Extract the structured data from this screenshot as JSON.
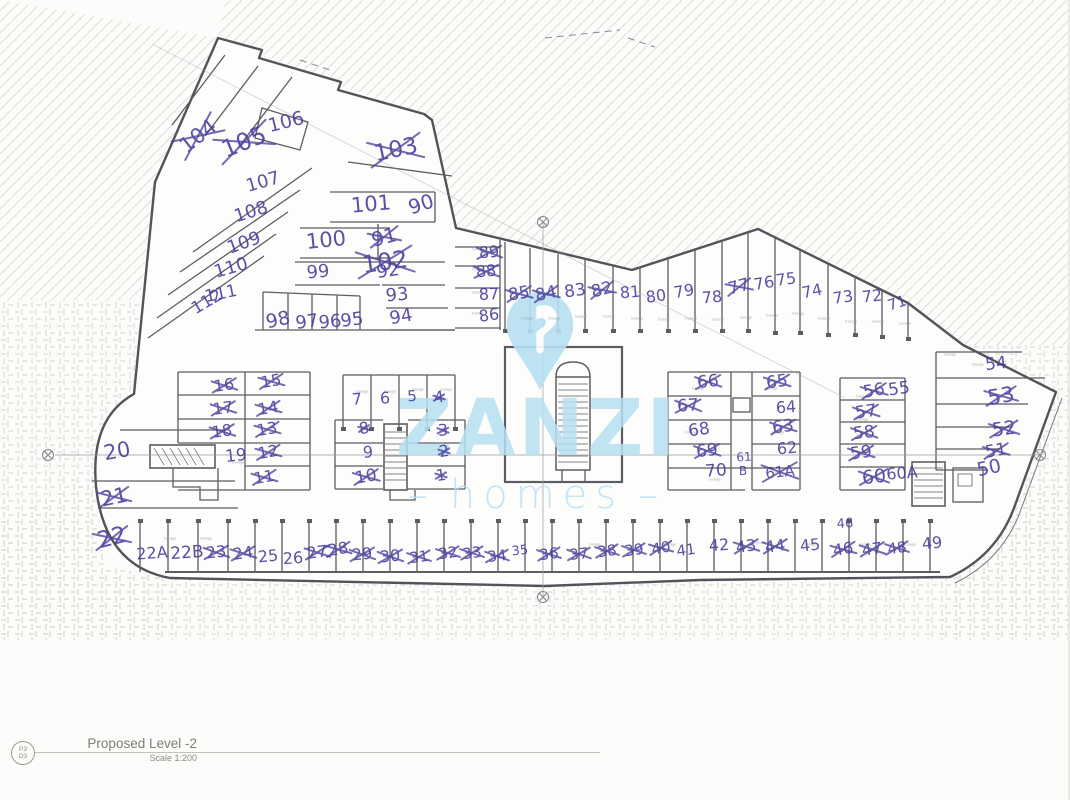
{
  "colors": {
    "ink": "#4a3f9d",
    "watermark": "#b7e0f2",
    "walls": "#55555a"
  },
  "title_block": {
    "sheet_top": "P3",
    "sheet_bottom": "D3",
    "title": "Proposed Level -2",
    "scale": "Scale 1:200"
  },
  "watermark": {
    "brand": "ZANZI",
    "word": "homes",
    "dash": "–"
  },
  "garage_label": "Garage",
  "garage_tags": [
    [
      517,
      316
    ],
    [
      544,
      316
    ],
    [
      571,
      314
    ],
    [
      599,
      314
    ],
    [
      627,
      316
    ],
    [
      654,
      317
    ],
    [
      681,
      316
    ],
    [
      708,
      317
    ],
    [
      736,
      315
    ],
    [
      762,
      313
    ],
    [
      788,
      311
    ],
    [
      814,
      316
    ],
    [
      841,
      319
    ],
    [
      868,
      319
    ],
    [
      895,
      321
    ],
    [
      468,
      247
    ],
    [
      468,
      267
    ],
    [
      468,
      290
    ],
    [
      468,
      311
    ],
    [
      352,
      389
    ],
    [
      380,
      389
    ],
    [
      408,
      387
    ],
    [
      436,
      387
    ],
    [
      688,
      386
    ],
    [
      762,
      386
    ],
    [
      681,
      430
    ],
    [
      768,
      430
    ],
    [
      852,
      394
    ],
    [
      852,
      417
    ],
    [
      160,
      536
    ],
    [
      196,
      536
    ],
    [
      585,
      542
    ],
    [
      660,
      542
    ],
    [
      750,
      540
    ],
    [
      800,
      542
    ],
    [
      855,
      542
    ],
    [
      900,
      542
    ],
    [
      940,
      352
    ],
    [
      968,
      362
    ],
    [
      705,
      477
    ],
    [
      228,
      460
    ]
  ],
  "stalls": [
    {
      "label": "104",
      "x": 198,
      "y": 136,
      "size": 21,
      "rot": -38,
      "crossed": true
    },
    {
      "label": "105",
      "x": 244,
      "y": 142,
      "size": 24,
      "rot": -22,
      "crossed": true
    },
    {
      "label": "106",
      "x": 286,
      "y": 122,
      "size": 19,
      "rot": -14,
      "crossed": false
    },
    {
      "label": "103",
      "x": 396,
      "y": 150,
      "size": 23,
      "rot": -12,
      "crossed": true
    },
    {
      "label": "107",
      "x": 263,
      "y": 182,
      "size": 18,
      "rot": -16,
      "crossed": false
    },
    {
      "label": "108",
      "x": 251,
      "y": 212,
      "size": 18,
      "rot": -18,
      "crossed": false
    },
    {
      "label": "109",
      "x": 244,
      "y": 243,
      "size": 18,
      "rot": -20,
      "crossed": false
    },
    {
      "label": "110",
      "x": 231,
      "y": 268,
      "size": 18,
      "rot": -16,
      "crossed": false
    },
    {
      "label": "111",
      "x": 221,
      "y": 294,
      "size": 17,
      "rot": -12,
      "crossed": false
    },
    {
      "label": "112",
      "x": 207,
      "y": 302,
      "size": 17,
      "rot": -30,
      "crossed": false
    },
    {
      "label": "102",
      "x": 385,
      "y": 262,
      "size": 24,
      "rot": -8,
      "crossed": true
    },
    {
      "label": "101",
      "x": 371,
      "y": 204,
      "size": 21,
      "rot": -5,
      "crossed": false
    },
    {
      "label": "90",
      "x": 421,
      "y": 204,
      "size": 20,
      "rot": -18,
      "crossed": false
    },
    {
      "label": "100",
      "x": 326,
      "y": 240,
      "size": 21,
      "rot": -6,
      "crossed": false
    },
    {
      "label": "91",
      "x": 384,
      "y": 237,
      "size": 20,
      "rot": -15,
      "crossed": true
    },
    {
      "label": "99",
      "x": 318,
      "y": 272,
      "size": 18,
      "rot": -5,
      "crossed": false
    },
    {
      "label": "92",
      "x": 388,
      "y": 271,
      "size": 18,
      "rot": -8,
      "crossed": false
    },
    {
      "label": "93",
      "x": 397,
      "y": 295,
      "size": 18,
      "rot": -5,
      "crossed": false
    },
    {
      "label": "94",
      "x": 401,
      "y": 317,
      "size": 18,
      "rot": -10,
      "crossed": false
    },
    {
      "label": "98",
      "x": 278,
      "y": 320,
      "size": 19,
      "rot": -12,
      "crossed": false
    },
    {
      "label": "97",
      "x": 307,
      "y": 322,
      "size": 18,
      "rot": -8,
      "crossed": false
    },
    {
      "label": "96",
      "x": 330,
      "y": 322,
      "size": 18,
      "rot": -5,
      "crossed": false
    },
    {
      "label": "95",
      "x": 352,
      "y": 320,
      "size": 18,
      "rot": -8,
      "crossed": false
    },
    {
      "label": "89",
      "x": 489,
      "y": 252,
      "size": 16,
      "rot": -5,
      "crossed": true
    },
    {
      "label": "88",
      "x": 486,
      "y": 271,
      "size": 16,
      "rot": -5,
      "crossed": true
    },
    {
      "label": "87",
      "x": 489,
      "y": 294,
      "size": 16,
      "rot": -3,
      "crossed": false
    },
    {
      "label": "86",
      "x": 489,
      "y": 315,
      "size": 16,
      "rot": -8,
      "crossed": false
    },
    {
      "label": "85",
      "x": 519,
      "y": 294,
      "size": 17,
      "rot": -10,
      "crossed": true
    },
    {
      "label": "84",
      "x": 546,
      "y": 294,
      "size": 17,
      "rot": -12,
      "crossed": true
    },
    {
      "label": "83",
      "x": 575,
      "y": 291,
      "size": 17,
      "rot": -8,
      "crossed": false
    },
    {
      "label": "82",
      "x": 602,
      "y": 290,
      "size": 17,
      "rot": -15,
      "crossed": true
    },
    {
      "label": "81",
      "x": 630,
      "y": 292,
      "size": 16,
      "rot": -5,
      "crossed": false
    },
    {
      "label": "80",
      "x": 656,
      "y": 296,
      "size": 16,
      "rot": -8,
      "crossed": false
    },
    {
      "label": "79",
      "x": 684,
      "y": 291,
      "size": 16,
      "rot": -10,
      "crossed": false
    },
    {
      "label": "78",
      "x": 712,
      "y": 297,
      "size": 16,
      "rot": -5,
      "crossed": false
    },
    {
      "label": "77",
      "x": 739,
      "y": 287,
      "size": 17,
      "rot": -15,
      "crossed": true
    },
    {
      "label": "76",
      "x": 764,
      "y": 283,
      "size": 16,
      "rot": -10,
      "crossed": false
    },
    {
      "label": "75",
      "x": 786,
      "y": 279,
      "size": 16,
      "rot": -8,
      "crossed": false
    },
    {
      "label": "74",
      "x": 812,
      "y": 291,
      "size": 16,
      "rot": -12,
      "crossed": false
    },
    {
      "label": "73",
      "x": 843,
      "y": 297,
      "size": 16,
      "rot": -8,
      "crossed": false
    },
    {
      "label": "72",
      "x": 872,
      "y": 296,
      "size": 16,
      "rot": -6,
      "crossed": false
    },
    {
      "label": "71",
      "x": 897,
      "y": 303,
      "size": 15,
      "rot": -18,
      "crossed": false
    },
    {
      "label": "54",
      "x": 996,
      "y": 364,
      "size": 17,
      "rot": -6,
      "crossed": false
    },
    {
      "label": "53",
      "x": 1001,
      "y": 396,
      "size": 21,
      "rot": -10,
      "crossed": true
    },
    {
      "label": "52",
      "x": 1004,
      "y": 429,
      "size": 19,
      "rot": -8,
      "crossed": true
    },
    {
      "label": "51",
      "x": 996,
      "y": 451,
      "size": 17,
      "rot": -10,
      "crossed": true
    },
    {
      "label": "50",
      "x": 989,
      "y": 468,
      "size": 19,
      "rot": -12,
      "crossed": false
    },
    {
      "label": "56",
      "x": 874,
      "y": 391,
      "size": 17,
      "rot": -10,
      "crossed": true
    },
    {
      "label": "55",
      "x": 899,
      "y": 389,
      "size": 17,
      "rot": -8,
      "crossed": false
    },
    {
      "label": "57",
      "x": 866,
      "y": 412,
      "size": 17,
      "rot": -8,
      "crossed": true
    },
    {
      "label": "58",
      "x": 864,
      "y": 433,
      "size": 17,
      "rot": -6,
      "crossed": true
    },
    {
      "label": "59",
      "x": 861,
      "y": 453,
      "size": 17,
      "rot": -8,
      "crossed": true
    },
    {
      "label": "60",
      "x": 874,
      "y": 477,
      "size": 19,
      "rot": -6,
      "crossed": true
    },
    {
      "label": "60A",
      "x": 902,
      "y": 473,
      "size": 16,
      "rot": -4,
      "crossed": false
    },
    {
      "label": "66",
      "x": 708,
      "y": 382,
      "size": 17,
      "rot": -6,
      "crossed": true
    },
    {
      "label": "65",
      "x": 777,
      "y": 382,
      "size": 17,
      "rot": -8,
      "crossed": true
    },
    {
      "label": "67",
      "x": 688,
      "y": 406,
      "size": 17,
      "rot": -4,
      "crossed": true
    },
    {
      "label": "64",
      "x": 786,
      "y": 407,
      "size": 16,
      "rot": -4,
      "crossed": false
    },
    {
      "label": "68",
      "x": 699,
      "y": 430,
      "size": 17,
      "rot": -8,
      "crossed": false
    },
    {
      "label": "63",
      "x": 783,
      "y": 427,
      "size": 17,
      "rot": -8,
      "crossed": true
    },
    {
      "label": "69",
      "x": 707,
      "y": 451,
      "size": 17,
      "rot": -6,
      "crossed": true
    },
    {
      "label": "62",
      "x": 787,
      "y": 448,
      "size": 16,
      "rot": -6,
      "crossed": false
    },
    {
      "label": "70",
      "x": 716,
      "y": 471,
      "size": 17,
      "rot": -4,
      "crossed": false
    },
    {
      "label": "61",
      "x": 744,
      "y": 457,
      "size": 12,
      "rot": -4,
      "crossed": false
    },
    {
      "label": "B",
      "x": 743,
      "y": 471,
      "size": 12,
      "rot": 0,
      "crossed": false
    },
    {
      "label": "61A",
      "x": 780,
      "y": 472,
      "size": 15,
      "rot": -6,
      "crossed": true
    },
    {
      "label": "7",
      "x": 357,
      "y": 399,
      "size": 16,
      "rot": -4,
      "crossed": false
    },
    {
      "label": "6",
      "x": 385,
      "y": 398,
      "size": 16,
      "rot": -2,
      "crossed": false
    },
    {
      "label": "5",
      "x": 412,
      "y": 396,
      "size": 15,
      "rot": -4,
      "crossed": false
    },
    {
      "label": "4",
      "x": 439,
      "y": 397,
      "size": 16,
      "rot": -8,
      "crossed": true
    },
    {
      "label": "8",
      "x": 364,
      "y": 428,
      "size": 16,
      "rot": -10,
      "crossed": true
    },
    {
      "label": "3",
      "x": 443,
      "y": 430,
      "size": 16,
      "rot": -4,
      "crossed": true
    },
    {
      "label": "9",
      "x": 368,
      "y": 452,
      "size": 16,
      "rot": -4,
      "crossed": false
    },
    {
      "label": "2",
      "x": 444,
      "y": 451,
      "size": 16,
      "rot": -8,
      "crossed": true
    },
    {
      "label": "10",
      "x": 366,
      "y": 477,
      "size": 17,
      "rot": -10,
      "crossed": true
    },
    {
      "label": "1",
      "x": 441,
      "y": 475,
      "size": 16,
      "rot": -8,
      "crossed": true
    },
    {
      "label": "16",
      "x": 224,
      "y": 385,
      "size": 16,
      "rot": -8,
      "crossed": true
    },
    {
      "label": "15",
      "x": 271,
      "y": 381,
      "size": 16,
      "rot": -10,
      "crossed": true
    },
    {
      "label": "17",
      "x": 223,
      "y": 408,
      "size": 16,
      "rot": -8,
      "crossed": true
    },
    {
      "label": "14",
      "x": 268,
      "y": 408,
      "size": 16,
      "rot": -10,
      "crossed": true
    },
    {
      "label": "18",
      "x": 222,
      "y": 431,
      "size": 16,
      "rot": -8,
      "crossed": true
    },
    {
      "label": "13",
      "x": 267,
      "y": 429,
      "size": 16,
      "rot": -10,
      "crossed": true
    },
    {
      "label": "19",
      "x": 236,
      "y": 456,
      "size": 17,
      "rot": -6,
      "crossed": false
    },
    {
      "label": "12",
      "x": 268,
      "y": 452,
      "size": 16,
      "rot": -10,
      "crossed": true
    },
    {
      "label": "11",
      "x": 264,
      "y": 477,
      "size": 16,
      "rot": -10,
      "crossed": true
    },
    {
      "label": "20",
      "x": 117,
      "y": 451,
      "size": 21,
      "rot": -10,
      "crossed": false
    },
    {
      "label": "21",
      "x": 114,
      "y": 497,
      "size": 21,
      "rot": -12,
      "crossed": true
    },
    {
      "label": "22",
      "x": 112,
      "y": 538,
      "size": 23,
      "rot": -14,
      "crossed": true
    },
    {
      "label": "22A",
      "x": 152,
      "y": 553,
      "size": 16,
      "rot": -4,
      "crossed": false
    },
    {
      "label": "22B",
      "x": 187,
      "y": 553,
      "size": 17,
      "rot": -4,
      "crossed": false
    },
    {
      "label": "23",
      "x": 216,
      "y": 552,
      "size": 16,
      "rot": -6,
      "crossed": true
    },
    {
      "label": "24",
      "x": 243,
      "y": 553,
      "size": 16,
      "rot": -8,
      "crossed": true
    },
    {
      "label": "25",
      "x": 268,
      "y": 556,
      "size": 16,
      "rot": -6,
      "crossed": false
    },
    {
      "label": "26",
      "x": 293,
      "y": 558,
      "size": 16,
      "rot": -4,
      "crossed": false
    },
    {
      "label": "27",
      "x": 317,
      "y": 552,
      "size": 16,
      "rot": -8,
      "crossed": true
    },
    {
      "label": "28",
      "x": 338,
      "y": 549,
      "size": 16,
      "rot": -10,
      "crossed": true
    },
    {
      "label": "29",
      "x": 362,
      "y": 554,
      "size": 16,
      "rot": -6,
      "crossed": true
    },
    {
      "label": "30",
      "x": 390,
      "y": 556,
      "size": 16,
      "rot": -6,
      "crossed": true
    },
    {
      "label": "31",
      "x": 419,
      "y": 557,
      "size": 15,
      "rot": -8,
      "crossed": true
    },
    {
      "label": "32",
      "x": 448,
      "y": 553,
      "size": 15,
      "rot": -8,
      "crossed": true
    },
    {
      "label": "33",
      "x": 472,
      "y": 553,
      "size": 15,
      "rot": -8,
      "crossed": true
    },
    {
      "label": "34",
      "x": 497,
      "y": 556,
      "size": 15,
      "rot": -6,
      "crossed": true
    },
    {
      "label": "35",
      "x": 520,
      "y": 551,
      "size": 13,
      "rot": -6,
      "crossed": false
    },
    {
      "label": "36",
      "x": 549,
      "y": 554,
      "size": 15,
      "rot": -8,
      "crossed": true
    },
    {
      "label": "37",
      "x": 579,
      "y": 554,
      "size": 15,
      "rot": -6,
      "crossed": true
    },
    {
      "label": "38",
      "x": 607,
      "y": 551,
      "size": 15,
      "rot": -8,
      "crossed": true
    },
    {
      "label": "39",
      "x": 634,
      "y": 550,
      "size": 15,
      "rot": -8,
      "crossed": true
    },
    {
      "label": "40",
      "x": 661,
      "y": 548,
      "size": 15,
      "rot": -10,
      "crossed": true
    },
    {
      "label": "41",
      "x": 686,
      "y": 550,
      "size": 15,
      "rot": -8,
      "crossed": false
    },
    {
      "label": "42",
      "x": 719,
      "y": 545,
      "size": 16,
      "rot": -4,
      "crossed": false
    },
    {
      "label": "43",
      "x": 746,
      "y": 546,
      "size": 16,
      "rot": -8,
      "crossed": true
    },
    {
      "label": "44",
      "x": 775,
      "y": 546,
      "size": 16,
      "rot": -8,
      "crossed": true
    },
    {
      "label": "45",
      "x": 810,
      "y": 545,
      "size": 16,
      "rot": -6,
      "crossed": false
    },
    {
      "label": "46",
      "x": 845,
      "y": 524,
      "size": 13,
      "rot": -4,
      "crossed": false
    },
    {
      "label": "46",
      "x": 843,
      "y": 549,
      "size": 16,
      "rot": -10,
      "crossed": true
    },
    {
      "label": "47",
      "x": 872,
      "y": 549,
      "size": 16,
      "rot": -8,
      "crossed": true
    },
    {
      "label": "48",
      "x": 897,
      "y": 548,
      "size": 15,
      "rot": -8,
      "crossed": true
    },
    {
      "label": "49",
      "x": 932,
      "y": 543,
      "size": 16,
      "rot": -6,
      "crossed": false
    }
  ]
}
